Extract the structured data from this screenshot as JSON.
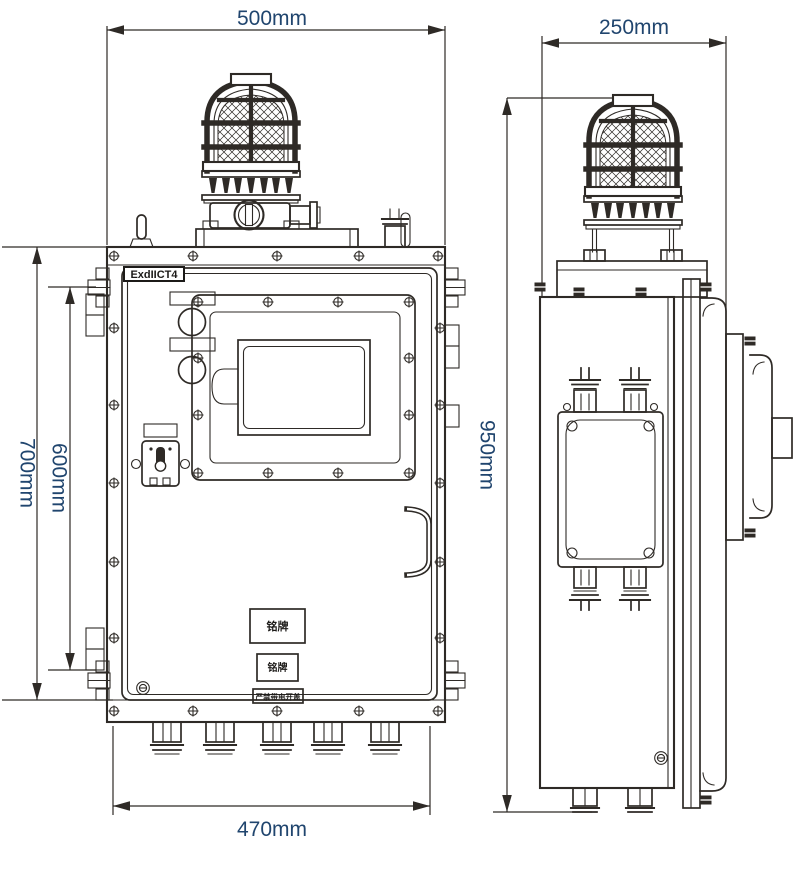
{
  "drawing": {
    "front_view": {
      "dim_top_width": "500mm",
      "dim_bottom_width": "470mm",
      "dim_height_overall": "700mm",
      "dim_height_door": "600mm",
      "ex_marking": "ExdIICT4",
      "nameplate_upper": "铭牌",
      "nameplate_lower": "铭牌",
      "warning_label": "严禁带电开盖"
    },
    "side_view": {
      "dim_depth": "250mm",
      "dim_height_overall": "950mm"
    },
    "colors": {
      "line": "#2e2a26",
      "dimension_text": "#20456e",
      "background": "#ffffff"
    }
  }
}
